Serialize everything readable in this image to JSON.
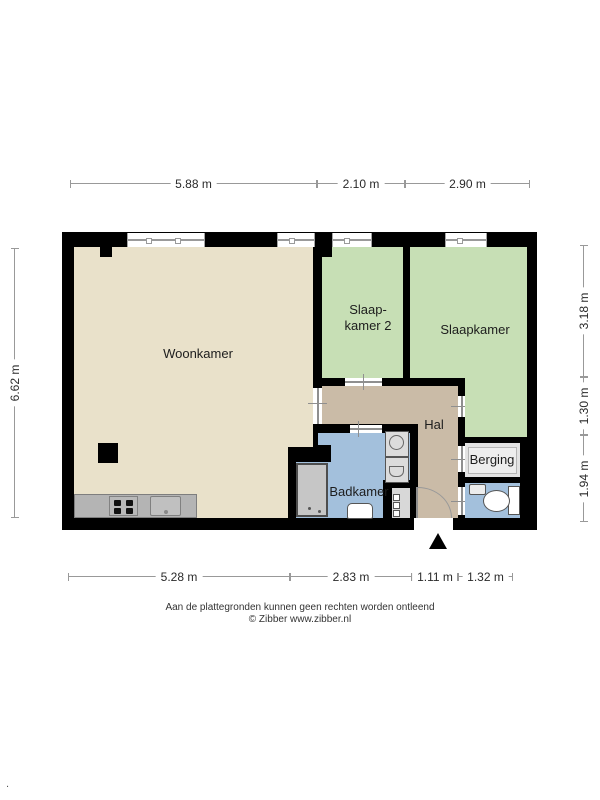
{
  "title": "Floor plan (plattegrond)",
  "colors": {
    "wall": "#000000",
    "woonkamer_floor": "#e9e1ca",
    "bedroom_floor": "#c7dfb5",
    "hal_floor": "#cabba7",
    "bathroom_floor": "#a3c0dc",
    "berging_floor": "#e2e2e2",
    "kitchen_counter": "#b4b4b4",
    "dimension_line": "#999999"
  },
  "rooms": {
    "woonkamer": {
      "label": "Woonkamer"
    },
    "slaapkamer2": {
      "line1": "Slaap-",
      "line2": "kamer 2"
    },
    "slaapkamer": {
      "label": "Slaapkamer"
    },
    "hal": {
      "label": "Hal"
    },
    "badkamer": {
      "label": "Badkamer"
    },
    "berging": {
      "label": "Berging"
    }
  },
  "dimensions": {
    "top": [
      {
        "label": "5.88 m"
      },
      {
        "label": "2.10 m"
      },
      {
        "label": "2.90 m"
      }
    ],
    "bottom": [
      {
        "label": "5.28 m"
      },
      {
        "label": "2.83 m"
      },
      {
        "label": "1.11 m"
      },
      {
        "label": "1.32 m"
      }
    ],
    "left": [
      {
        "label": "6.62 m"
      }
    ],
    "right": [
      {
        "label": "3.18 m"
      },
      {
        "label": "1.30 m"
      },
      {
        "label": "1.94 m"
      }
    ]
  },
  "footer": {
    "disclaimer": "Aan de plattegronden kunnen geen rechten worden ontleend",
    "copyright": "© Zibber www.zibber.nl",
    "corner_mark": "."
  }
}
